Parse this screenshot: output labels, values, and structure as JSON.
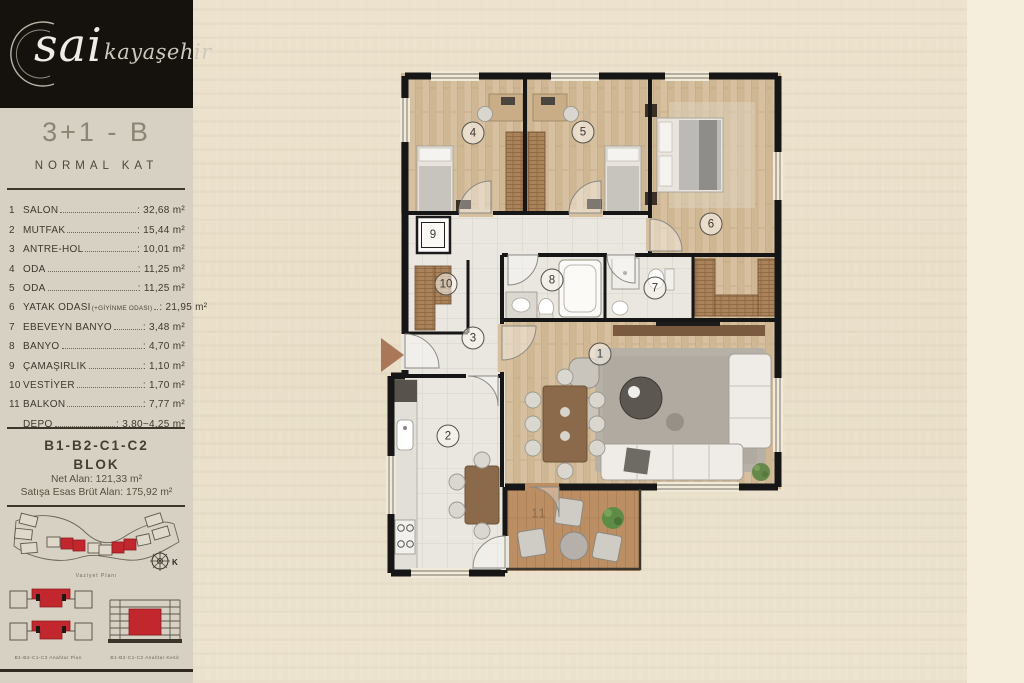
{
  "logo": {
    "brand": "sai",
    "sub": "kayaşehir"
  },
  "sidebar": {
    "unit_type": "3+1 - B",
    "floor_label": "NORMAL KAT",
    "rooms": [
      {
        "no": "1",
        "name": "SALON",
        "area": ": 32,68 m²"
      },
      {
        "no": "2",
        "name": "MUTFAK",
        "area": ": 15,44 m²"
      },
      {
        "no": "3",
        "name": "ANTRE-HOL",
        "area": ": 10,01 m²"
      },
      {
        "no": "4",
        "name": "ODA",
        "area": ": 11,25 m²"
      },
      {
        "no": "5",
        "name": "ODA",
        "area": ": 11,25 m²"
      },
      {
        "no": "6",
        "name": "YATAK ODASI",
        "note": "(+GİYİNME ODASI)",
        "area": ": 21,95 m²"
      },
      {
        "no": "7",
        "name": "EBEVEYN BANYO",
        "area": ": 3,48 m²"
      },
      {
        "no": "8",
        "name": "BANYO",
        "area": ": 4,70 m²"
      },
      {
        "no": "9",
        "name": "ÇAMAŞIRLIK",
        "area": ": 1,10 m²"
      },
      {
        "no": "10",
        "name": "VESTİYER",
        "area": ": 1,70 m²"
      },
      {
        "no": "11",
        "name": "BALKON",
        "area": ": 7,77 m²"
      },
      {
        "no": "",
        "name": "DEPO",
        "area": ": 3,80~4,25 m²"
      }
    ],
    "block_line1": "B1-B2-C1-C2",
    "block_line2": "BLOK",
    "net_alan": "Net Alan: 121,33 m²",
    "brut_alan": "Satışa Esas Brüt Alan: 175,92 m²",
    "site_plan_caption": "Vaziyet Planı",
    "compass_label": "K",
    "key_plan_caption": "B1-B2-C1-C2 Anahtar Plan",
    "key_section_caption": "B1-B2-C1-C2 Anahtar Kesit",
    "accent_red": "#c1272d"
  },
  "plan": {
    "labels": [
      {
        "num": "1",
        "x": 227,
        "y": 286,
        "style": "circle"
      },
      {
        "num": "2",
        "x": 75,
        "y": 368,
        "style": "circle"
      },
      {
        "num": "3",
        "x": 100,
        "y": 270,
        "style": "circle"
      },
      {
        "num": "4",
        "x": 100,
        "y": 65,
        "style": "circle"
      },
      {
        "num": "5",
        "x": 210,
        "y": 64,
        "style": "circle"
      },
      {
        "num": "6",
        "x": 338,
        "y": 156,
        "style": "circle"
      },
      {
        "num": "7",
        "x": 282,
        "y": 220,
        "style": "circle"
      },
      {
        "num": "8",
        "x": 179,
        "y": 212,
        "style": "circle"
      },
      {
        "num": "9",
        "x": 60,
        "y": 167,
        "style": "square"
      },
      {
        "num": "10",
        "x": 73,
        "y": 216,
        "style": "circle"
      },
      {
        "num": "11",
        "x": 166,
        "y": 445,
        "style": "plain"
      }
    ]
  }
}
